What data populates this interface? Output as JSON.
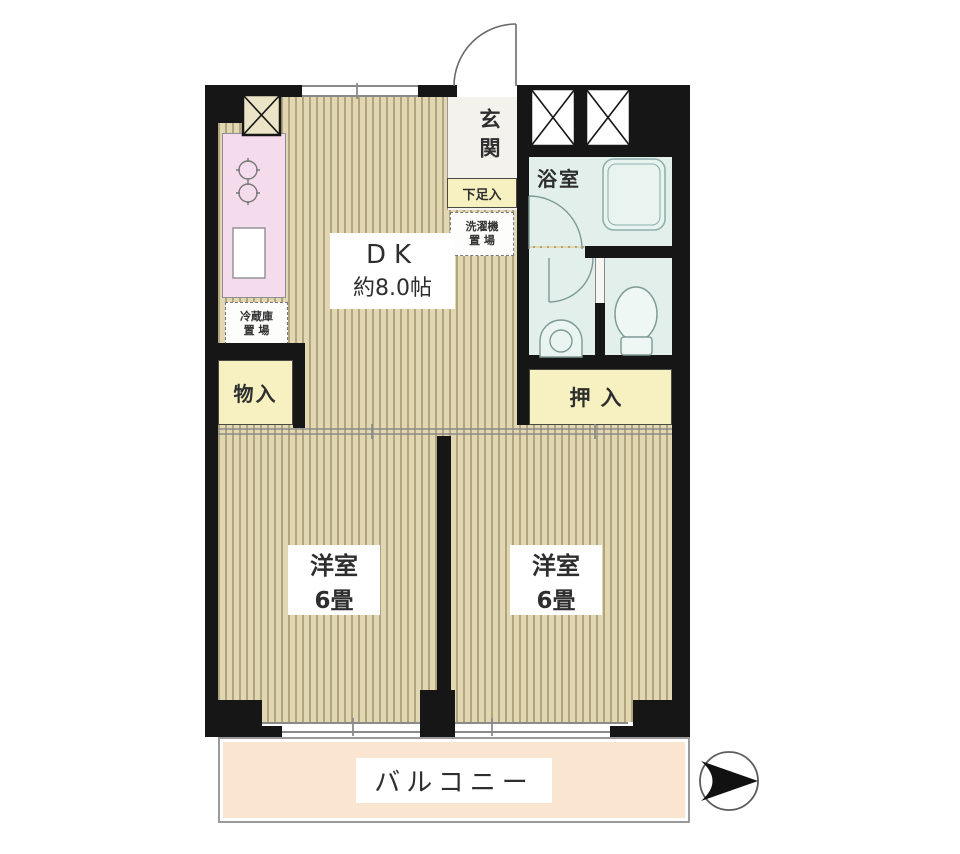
{
  "plan_title": "2DK apartment floor plan",
  "rooms": {
    "dk": {
      "name": "DK",
      "size": "約8.0帖"
    },
    "entrance": {
      "name": "玄関"
    },
    "shoe_storage": {
      "name": "下足入"
    },
    "washer_space": {
      "line1": "洗濯機",
      "line2": "置 場"
    },
    "fridge_space": {
      "line1": "冷蔵庫",
      "line2": "置 場"
    },
    "bathroom": {
      "name": "浴室"
    },
    "storage": {
      "name": "物入"
    },
    "closet": {
      "name": "押入"
    },
    "western_room_left": {
      "name": "洋室",
      "size": "6畳"
    },
    "western_room_right": {
      "name": "洋室",
      "size": "6畳"
    },
    "balcony": {
      "name": "バルコニー"
    }
  },
  "icons": {
    "compass": "direction-arrow-right",
    "pillar_shaft": "x-cross-box",
    "stove": "two-burner-circles",
    "bathtub": "rounded-tub",
    "toilet": "toilet-bowl",
    "washbasin": "round-basin"
  },
  "colors": {
    "wall": "#161616",
    "floor_light": "#e1d7b3",
    "floor_dark": "#b2a57d",
    "closet_yellow": "#f7f1c1",
    "wet_area_blue": "#e2efeb",
    "kitchen_pink": "#f5dcec",
    "balcony_peach": "#fae5d1",
    "line_gray": "#8a8a8a"
  }
}
